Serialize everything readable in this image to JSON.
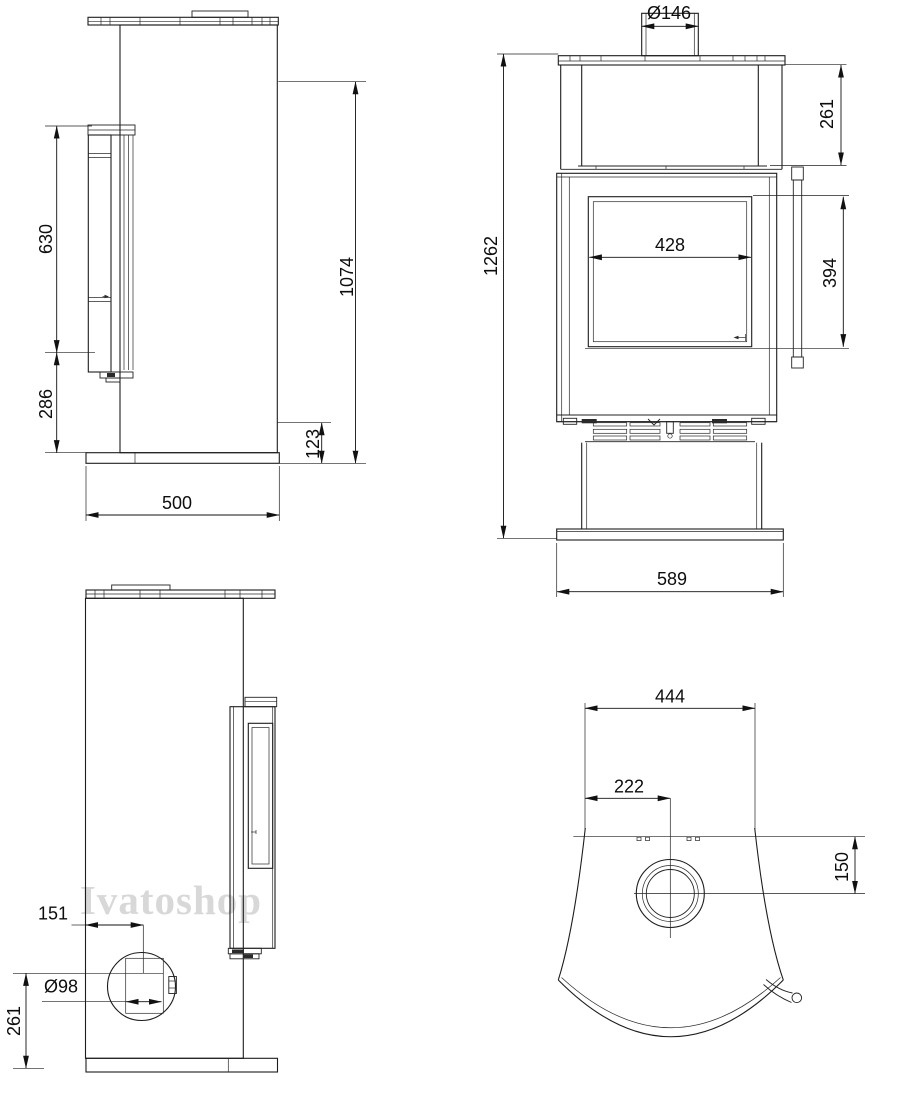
{
  "watermark": "Ivatoshop",
  "views": {
    "side_top": {
      "dims": {
        "door_height": "630",
        "lower_height": "286",
        "overall_height": "1074",
        "base_height": "123",
        "depth": "500"
      }
    },
    "front": {
      "dims": {
        "flue_diameter": "Ø146",
        "top_offset": "261",
        "total_height": "1262",
        "glass_width": "428",
        "glass_height": "394",
        "base_width": "589"
      }
    },
    "side_bottom": {
      "dims": {
        "outlet_offset": "151",
        "outlet_diameter": "Ø98",
        "outlet_height": "261"
      }
    },
    "top_view": {
      "dims": {
        "top_width": "444",
        "half_width": "222",
        "flue_offset": "150"
      }
    }
  }
}
